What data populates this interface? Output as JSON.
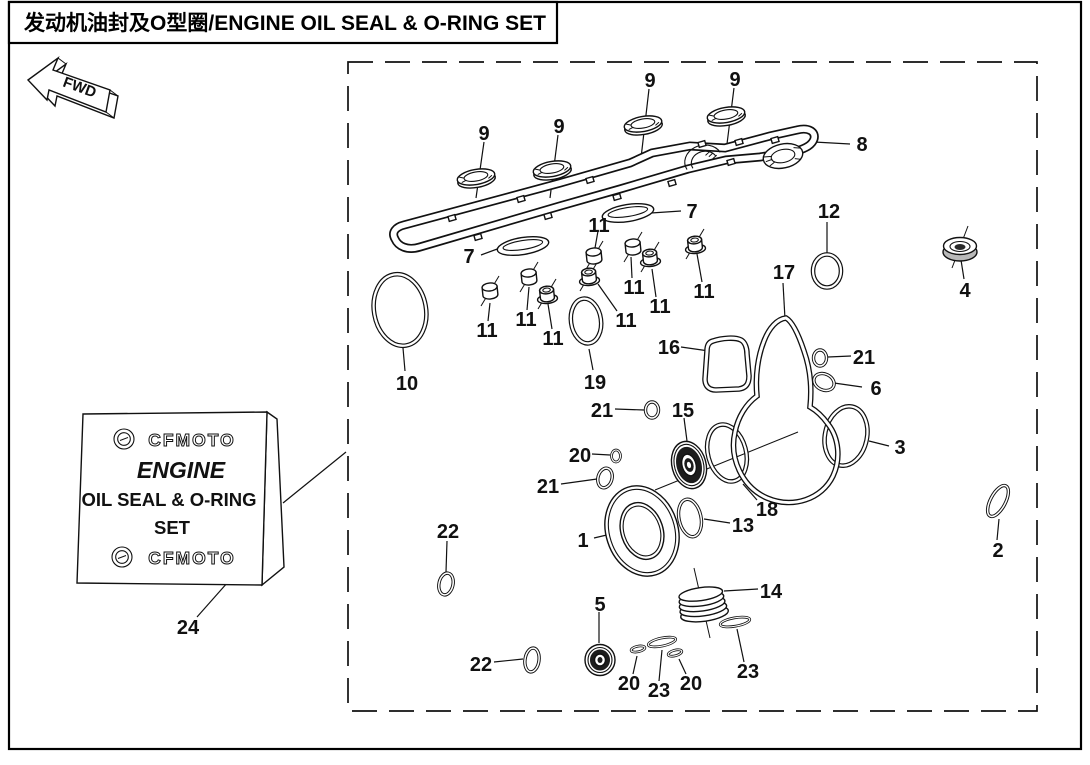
{
  "page": {
    "title": "发动机油封及O型圈/ENGINE OIL SEAL & O-RING SET"
  },
  "direction_arrow": {
    "label": "FWD"
  },
  "kit_label": {
    "brand_top": "CFMOTO",
    "title_line1": "ENGINE",
    "title_line2": "OIL SEAL & O-RING",
    "title_line3": "SET",
    "brand_bottom": "CFMOTO"
  },
  "callouts": {
    "c9a": "9",
    "c9b": "9",
    "c9c": "9",
    "c9d": "9",
    "c8": "8",
    "c7a": "7",
    "c7b": "7",
    "c11a": "11",
    "c11b": "11",
    "c11c": "11",
    "c11d": "11",
    "c11e": "11",
    "c11f": "11",
    "c11g": "11",
    "c11h": "11",
    "c12": "12",
    "c4": "4",
    "c17": "17",
    "c16": "16",
    "c21a": "21",
    "c6": "6",
    "c3": "3",
    "c10": "10",
    "c19": "19",
    "c21b": "21",
    "c15": "15",
    "c20a": "20",
    "c21c": "21",
    "c1": "1",
    "c13": "13",
    "c18": "18",
    "c2": "2",
    "c22a": "22",
    "c14": "14",
    "c5": "5",
    "c24": "24",
    "c22b": "22",
    "c20b": "20",
    "c23a": "23",
    "c20c": "20",
    "c23b": "23"
  }
}
